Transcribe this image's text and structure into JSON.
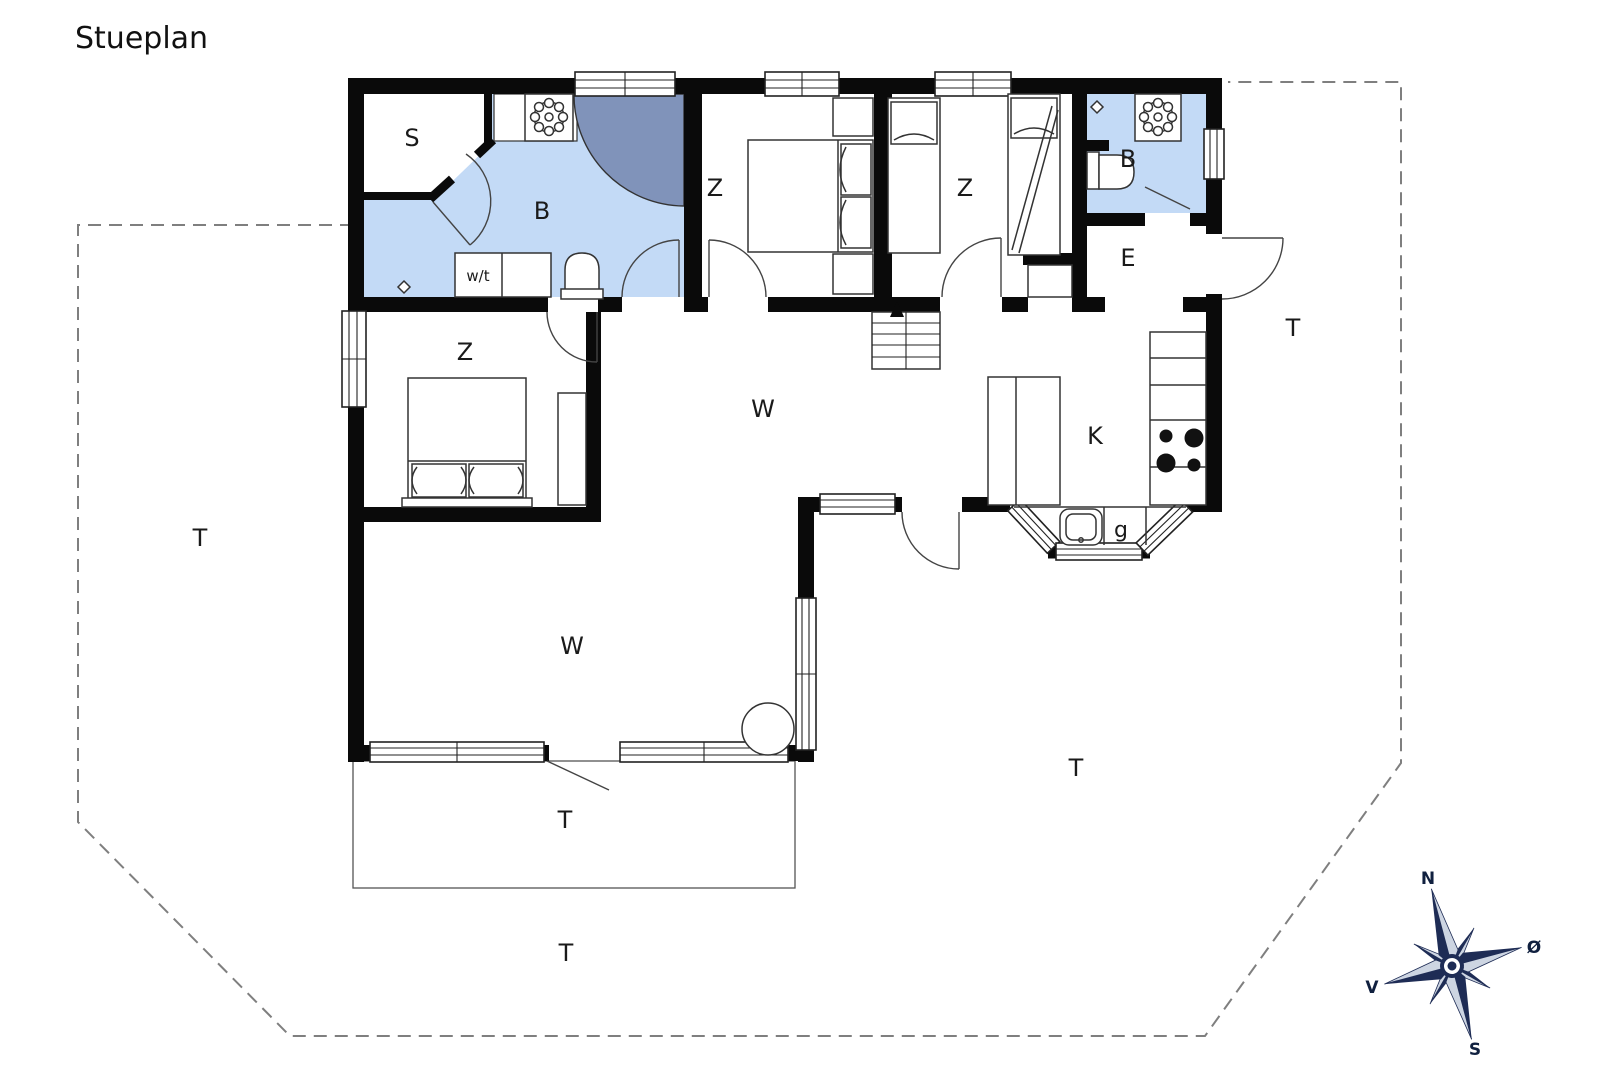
{
  "title": "Stueplan",
  "rooms": {
    "sauna": "S",
    "bathroom_main": "B",
    "bathroom_2": "B",
    "bedroom_1": "Z",
    "bedroom_2": "Z",
    "bedroom_3": "Z",
    "entrance": "E",
    "living_upper": "W",
    "living_lower": "W",
    "kitchen": "K",
    "pantry": "g",
    "washer_dryer": "w/t"
  },
  "terrace": {
    "label": "T"
  },
  "compass": {
    "north": "N",
    "east": "Ø",
    "south": "S",
    "west": "V"
  },
  "colors": {
    "wall": "#0a0a0a",
    "bathroom_fill": "#c3daf6",
    "shower_fill": "#8093ba",
    "compass_navy": "#1e2c55",
    "compass_light": "#cdd5e2",
    "boundary_dash": "#7f7f7f"
  }
}
